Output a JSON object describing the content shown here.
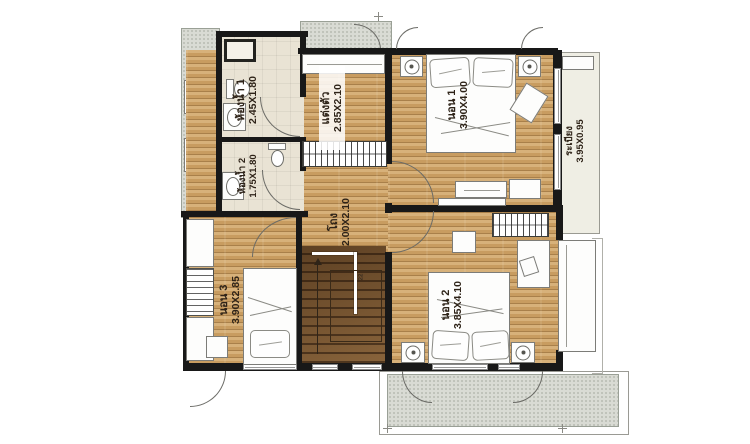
{
  "plan": {
    "type": "second-floor-plan",
    "rooms": {
      "bath1": {
        "name": "ห้องน้ำ 1",
        "dim": "2.45X1.80"
      },
      "bath2": {
        "name": "ห้องน้ำ 2",
        "dim": "1.75X1.80"
      },
      "dressing": {
        "name": "แต่งตัว",
        "dim": "2.85X2.10"
      },
      "bed1": {
        "name": "นอน 1",
        "dim": "3.90X4.00"
      },
      "balcony": {
        "name": "ระเบียง",
        "dim": "3.95X0.95"
      },
      "hall": {
        "name": "โถง",
        "dim": "2.00X2.10"
      },
      "bed3": {
        "name": "นอน 3",
        "dim": "3.90X2.85"
      },
      "bed2": {
        "name": "นอน 2",
        "dim": "3.85X4.10"
      }
    },
    "stair_mark": "22",
    "colors": {
      "wood_floor": "#c89c60",
      "stair_wood": "#6b4b28",
      "bath_floor": "#e9e3d4",
      "balcony_floor": "#efeee4",
      "concrete": "#d9dbd4",
      "wall": "#181818",
      "label_text": "#2e2318"
    }
  }
}
